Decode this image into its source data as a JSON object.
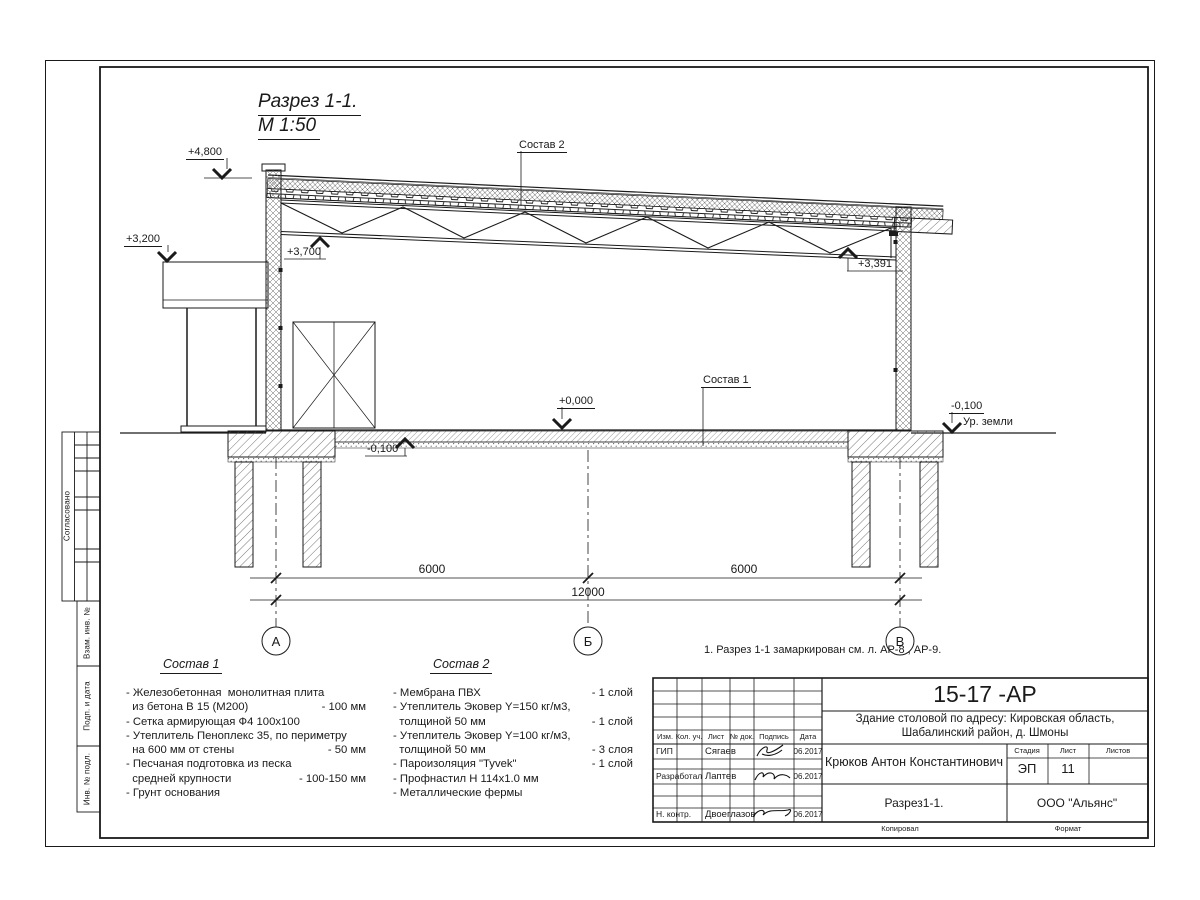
{
  "page": {
    "title_line1": "Разрез 1-1.",
    "title_line2": "М 1:50",
    "note": "1. Разрез 1-1 замаркирован см. л. АР-8 , АР-9."
  },
  "elevations": {
    "e4800": "+4,800",
    "e3200": "+3,200",
    "e3700": "+3,700",
    "e3391": "+3,391",
    "e0000": "+0,000",
    "em100_left": "-0,100",
    "em100_right": "-0,100",
    "ground": "Ур. земли"
  },
  "callouts": {
    "sostav1": "Состав 1",
    "sostav2": "Состав 2"
  },
  "dims": {
    "left": "6000",
    "right": "6000",
    "total": "12000"
  },
  "axes": {
    "a": "А",
    "b": "Б",
    "v": "В"
  },
  "sostav1": {
    "title": "Состав 1",
    "rows": [
      {
        "t": "- Железобетонная  монолитная плита",
        "q": ""
      },
      {
        "t": "  из бетона В 15 (М200)",
        "q": "- 100 мм"
      },
      {
        "t": "- Сетка армирующая Ф4 100х100",
        "q": ""
      },
      {
        "t": "- Утеплитель Пеноплекс 35, по периметру",
        "q": ""
      },
      {
        "t": "  на 600 мм от стены",
        "q": "- 50 мм"
      },
      {
        "t": "- Песчаная подготовка из песка",
        "q": ""
      },
      {
        "t": "  средней крупности",
        "q": "- 100-150 мм"
      },
      {
        "t": "- Грунт основания",
        "q": ""
      }
    ]
  },
  "sostav2": {
    "title": "Состав 2",
    "rows": [
      {
        "t": "- Мембрана ПВХ",
        "q": "- 1 слой"
      },
      {
        "t": "- Утеплитель Эковер Y=150 кг/м3,",
        "q": ""
      },
      {
        "t": "  толщиной 50 мм",
        "q": "- 1 слой"
      },
      {
        "t": "- Утеплитель Эковер Y=100 кг/м3,",
        "q": ""
      },
      {
        "t": "  толщиной 50 мм",
        "q": "- 3 слоя"
      },
      {
        "t": "- Пароизоляция \"Tyvek\"",
        "q": "- 1 слой"
      },
      {
        "t": "- Профнастил Н 114х1.0 мм",
        "q": ""
      },
      {
        "t": "- Металлические фермы",
        "q": ""
      }
    ]
  },
  "titleblock": {
    "doc_number": "15-17 -АР",
    "project_line1": "Здание столовой по адресу: Кировская область,",
    "project_line2": "Шабалинский район, д. Шмоны",
    "author": "Крюков Антон Константинович",
    "drawing_name": "Разрез1-1.",
    "company": "ООО \"Альянс\"",
    "col_izm": "Изм.",
    "col_kol": "Кол. уч.",
    "col_list": "Лист",
    "col_doc": "№ док.",
    "col_sign": "Подпись",
    "col_date": "Дата",
    "rows": [
      {
        "role": "ГИП",
        "name": "Сягаев",
        "date": "06.2017"
      },
      {
        "role": "Разработал",
        "name": "Лаптев",
        "date": "06.2017"
      },
      {
        "role": "Н. контр.",
        "name": "Двоеглазов",
        "date": "06.2017"
      }
    ],
    "stage_label": "Стадия",
    "list_label": "Лист",
    "listov_label": "Листов",
    "stage": "ЭП",
    "sheet_no": "11",
    "copied": "Копировал",
    "format": "Формат"
  },
  "frame": {
    "soglasovano": "Согласовано",
    "vzam": "Взам. инв. №",
    "podp": "Подп. и дата",
    "inv": "Инв. № подл."
  }
}
